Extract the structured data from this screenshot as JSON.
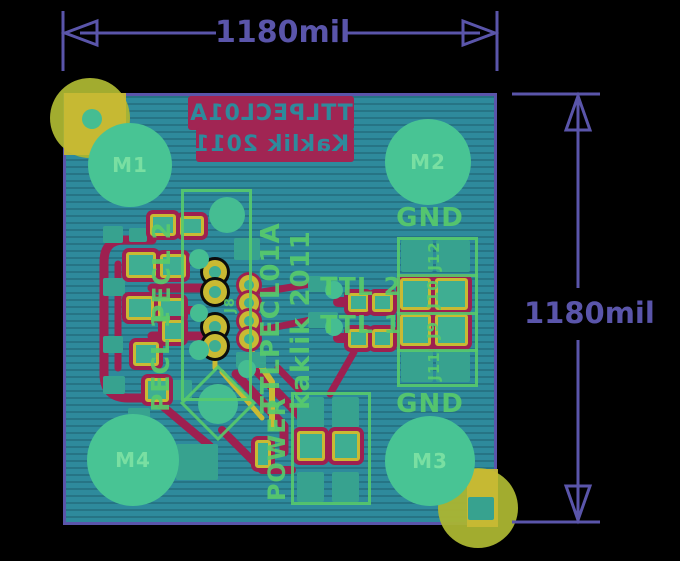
{
  "dimensions": {
    "top_label": "1180mil",
    "right_label": "1180mil"
  },
  "bottom_silk_block": {
    "line1": "TTLPECL01A",
    "line2": "Kaklik 2011",
    "mirrored": true
  },
  "colors": {
    "background": "#000000",
    "dimension": "#5a55aa",
    "board_copper": "#2e8a9c",
    "pad_green": "#48c494",
    "pad_teal": "#37a28f",
    "gold_pad": "#c9ba33",
    "fiducial_olive": "#abb531",
    "bottom_copper_crimson": "#9e2050",
    "silkscreen_green": "#58ca6b",
    "silk_block_crimson": "#a12553"
  },
  "board": {
    "outline": {
      "x": 63,
      "y": 93,
      "w": 434,
      "h": 432
    },
    "mounting_holes": [
      {
        "label": "M1",
        "cx": 130,
        "cy": 165,
        "r": 42
      },
      {
        "label": "M2",
        "cx": 428,
        "cy": 162,
        "r": 43
      },
      {
        "label": "M3",
        "cx": 430,
        "cy": 461,
        "r": 45
      },
      {
        "label": "M4",
        "cx": 133,
        "cy": 460,
        "r": 46
      }
    ],
    "silkscreen_texts": [
      {
        "id": "gnd-top",
        "label": "GND",
        "cx": 430,
        "cy": 218,
        "rot": 0,
        "size": 26
      },
      {
        "id": "gnd-bottom",
        "label": "GND",
        "cx": 430,
        "cy": 404,
        "rot": 0,
        "size": 26
      },
      {
        "id": "ttl2",
        "label": "TTL 2",
        "cx": 361,
        "cy": 286,
        "rot": 0,
        "size": 25
      },
      {
        "id": "ttl1",
        "label": "TTL 1",
        "cx": 361,
        "cy": 324,
        "rot": 0,
        "size": 25
      },
      {
        "id": "pecl2",
        "label": "PECL 2",
        "cx": 161,
        "cy": 272,
        "rot": -90,
        "size": 25
      },
      {
        "id": "pecl1",
        "label": "PECL 1",
        "cx": 160,
        "cy": 361,
        "rot": -90,
        "size": 25
      },
      {
        "id": "ttlpecl01a",
        "label": "TTLPECL01A",
        "cx": 271,
        "cy": 318,
        "rot": -90,
        "size": 26
      },
      {
        "id": "kaklik-2011",
        "label": "kaklik 2011",
        "cx": 301,
        "cy": 320,
        "rot": -90,
        "size": 26
      },
      {
        "id": "power",
        "label": "POWER",
        "cx": 277,
        "cy": 449,
        "rot": -90,
        "size": 24
      },
      {
        "id": "j12",
        "label": "J12",
        "cx": 434,
        "cy": 256,
        "rot": -90,
        "size": 15
      },
      {
        "id": "j10",
        "label": "J10",
        "cx": 433,
        "cy": 294,
        "rot": -90,
        "size": 15
      },
      {
        "id": "j9",
        "label": "J9",
        "cx": 433,
        "cy": 330,
        "rot": -90,
        "size": 15
      },
      {
        "id": "j11",
        "label": "J11",
        "cx": 434,
        "cy": 366,
        "rot": -90,
        "size": 15
      },
      {
        "id": "j8",
        "label": "J8",
        "cx": 230,
        "cy": 305,
        "rot": -90,
        "size": 13
      }
    ],
    "fiducials_olive": [
      {
        "cx": 90,
        "cy": 118,
        "r": 40
      },
      {
        "cx": 478,
        "cy": 508,
        "r": 40
      }
    ],
    "gold_squares": [
      {
        "x": 64,
        "y": 93,
        "w": 62,
        "h": 62
      },
      {
        "x": 467,
        "y": 469,
        "w": 31,
        "h": 58
      }
    ],
    "teal_accents": [
      {
        "type": "circle",
        "cx": 92,
        "cy": 119,
        "r": 10
      },
      {
        "type": "rect",
        "x": 468,
        "y": 497,
        "w": 26,
        "h": 23
      }
    ],
    "teal_pads": [
      {
        "x": 103,
        "y": 226,
        "w": 20,
        "h": 17
      },
      {
        "x": 129,
        "y": 228,
        "w": 18,
        "h": 14
      },
      {
        "x": 103,
        "y": 278,
        "w": 22,
        "h": 18
      },
      {
        "x": 103,
        "y": 336,
        "w": 20,
        "h": 17
      },
      {
        "x": 103,
        "y": 376,
        "w": 22,
        "h": 18
      },
      {
        "x": 128,
        "y": 408,
        "w": 22,
        "h": 18
      },
      {
        "x": 170,
        "y": 380,
        "w": 22,
        "h": 20
      },
      {
        "x": 176,
        "y": 444,
        "w": 42,
        "h": 36
      },
      {
        "x": 234,
        "y": 238,
        "w": 26,
        "h": 22
      },
      {
        "x": 236,
        "y": 352,
        "w": 30,
        "h": 16
      },
      {
        "x": 308,
        "y": 276,
        "w": 30,
        "h": 16
      },
      {
        "x": 308,
        "y": 312,
        "w": 30,
        "h": 16
      },
      {
        "x": 401,
        "y": 240,
        "w": 32,
        "h": 32
      },
      {
        "x": 436,
        "y": 240,
        "w": 34,
        "h": 32
      },
      {
        "x": 401,
        "y": 351,
        "w": 32,
        "h": 31
      },
      {
        "x": 436,
        "y": 351,
        "w": 34,
        "h": 31
      },
      {
        "x": 297,
        "y": 397,
        "w": 27,
        "h": 31
      },
      {
        "x": 332,
        "y": 397,
        "w": 27,
        "h": 31
      },
      {
        "x": 297,
        "y": 472,
        "w": 27,
        "h": 30
      },
      {
        "x": 332,
        "y": 472,
        "w": 27,
        "h": 30
      }
    ],
    "gold_ring_pads": [
      {
        "x": 150,
        "y": 214,
        "w": 26,
        "h": 22
      },
      {
        "x": 180,
        "y": 216,
        "w": 24,
        "h": 20
      },
      {
        "x": 126,
        "y": 252,
        "w": 30,
        "h": 26
      },
      {
        "x": 160,
        "y": 254,
        "w": 26,
        "h": 24
      },
      {
        "x": 126,
        "y": 296,
        "w": 28,
        "h": 24
      },
      {
        "x": 158,
        "y": 298,
        "w": 26,
        "h": 22
      },
      {
        "x": 162,
        "y": 320,
        "w": 22,
        "h": 22
      },
      {
        "x": 133,
        "y": 342,
        "w": 26,
        "h": 24
      },
      {
        "x": 145,
        "y": 378,
        "w": 24,
        "h": 24
      },
      {
        "x": 140,
        "y": 428,
        "w": 20,
        "h": 26
      },
      {
        "x": 255,
        "y": 440,
        "w": 16,
        "h": 28
      },
      {
        "x": 348,
        "y": 293,
        "w": 21,
        "h": 19
      },
      {
        "x": 372,
        "y": 293,
        "w": 21,
        "h": 19
      },
      {
        "x": 348,
        "y": 329,
        "w": 21,
        "h": 19
      },
      {
        "x": 372,
        "y": 329,
        "w": 21,
        "h": 19
      },
      {
        "x": 400,
        "y": 278,
        "w": 31,
        "h": 32
      },
      {
        "x": 435,
        "y": 278,
        "w": 33,
        "h": 32
      },
      {
        "x": 400,
        "y": 314,
        "w": 31,
        "h": 32
      },
      {
        "x": 435,
        "y": 314,
        "w": 33,
        "h": 32
      },
      {
        "x": 297,
        "y": 431,
        "w": 28,
        "h": 30
      },
      {
        "x": 332,
        "y": 431,
        "w": 28,
        "h": 30
      }
    ],
    "th_rings_black": [
      {
        "cx": 215,
        "cy": 272,
        "r": 12
      },
      {
        "cx": 215,
        "cy": 292,
        "r": 12
      },
      {
        "cx": 215,
        "cy": 327,
        "r": 12
      },
      {
        "cx": 215,
        "cy": 346,
        "r": 12
      }
    ],
    "th_rings_crimson": [
      {
        "cx": 249,
        "cy": 285,
        "r": 10
      },
      {
        "cx": 249,
        "cy": 303,
        "r": 10
      },
      {
        "cx": 249,
        "cy": 321,
        "r": 10
      },
      {
        "cx": 249,
        "cy": 339,
        "r": 10
      }
    ],
    "vias": [
      {
        "cx": 227,
        "cy": 215,
        "r": 18
      },
      {
        "cx": 199,
        "cy": 259,
        "r": 10
      },
      {
        "cx": 199,
        "cy": 313,
        "r": 9
      },
      {
        "cx": 199,
        "cy": 350,
        "r": 10
      },
      {
        "cx": 218,
        "cy": 404,
        "r": 20
      },
      {
        "cx": 334,
        "cy": 290,
        "r": 9
      },
      {
        "cx": 334,
        "cy": 327,
        "r": 9
      },
      {
        "cx": 247,
        "cy": 369,
        "r": 9
      }
    ],
    "silk_frames": [
      {
        "x": 181,
        "y": 189,
        "w": 71,
        "h": 212
      },
      {
        "x": 397,
        "y": 237,
        "w": 81,
        "h": 150
      },
      {
        "x": 291,
        "y": 392,
        "w": 80,
        "h": 113
      }
    ],
    "silk_frame_lines": [
      {
        "x": 397,
        "y": 274,
        "w": 81
      },
      {
        "x": 397,
        "y": 312,
        "w": 81
      },
      {
        "x": 397,
        "y": 349,
        "w": 81
      }
    ],
    "silk_diamond": {
      "cx": 218,
      "cy": 403,
      "size": 54
    },
    "crimson_traces": [
      {
        "d": "M152,240 L124,240 Q104,240 104,262 L104,374 Q104,398 128,398 L152,398",
        "w": 9
      },
      {
        "d": "M118,264 L118,368",
        "w": 7
      },
      {
        "d": "M152,288 L212,288",
        "w": 9
      },
      {
        "d": "M150,310 L192,310",
        "w": 8
      },
      {
        "d": "M152,336 L212,336",
        "w": 9
      },
      {
        "d": "M236,374 L284,426 L284,452",
        "w": 9
      },
      {
        "d": "M252,366 L302,418",
        "w": 9
      },
      {
        "d": "M160,404 L210,446",
        "w": 8
      },
      {
        "d": "M222,430 L262,470 L292,470",
        "w": 8
      },
      {
        "d": "M330,394 L354,352",
        "w": 7
      },
      {
        "d": "M338,302 L398,302",
        "w": 10
      },
      {
        "d": "M338,338 L398,338",
        "w": 10
      },
      {
        "d": "M432,280 L432,348",
        "w": 8
      },
      {
        "d": "M262,292 L310,284",
        "w": 7
      },
      {
        "d": "M262,330 L310,320",
        "w": 7
      },
      {
        "d": "M299,390 L278,368",
        "w": 7
      }
    ],
    "gold_traces": [
      {
        "d": "M249,295 L249,339",
        "w": 5
      },
      {
        "d": "M250,350 L272,382 L272,428",
        "w": 6
      },
      {
        "d": "M222,372 L262,418",
        "w": 5
      },
      {
        "d": "M215,352 L215,368",
        "w": 5
      }
    ],
    "crimson_block_parts": [
      {
        "x": 0,
        "y": 0,
        "w": 166,
        "h": 34
      },
      {
        "x": 8,
        "y": 32,
        "w": 158,
        "h": 34
      }
    ]
  }
}
